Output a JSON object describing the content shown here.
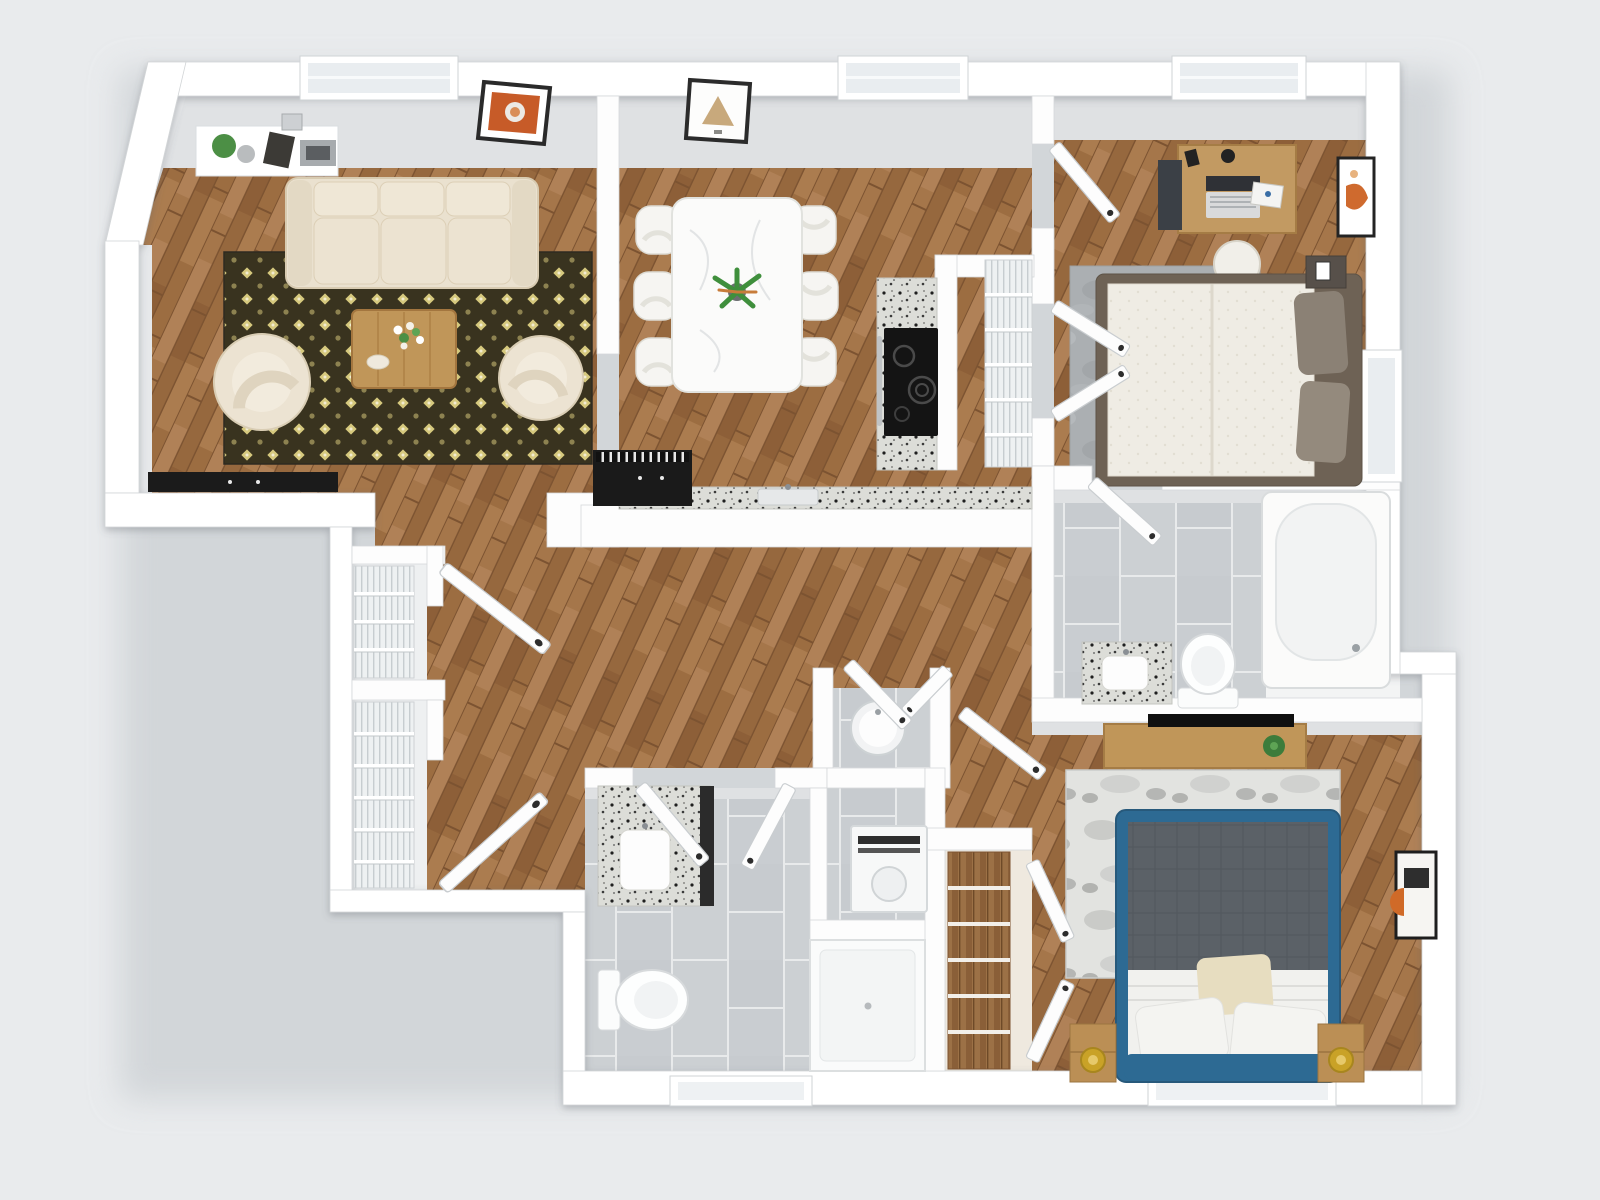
{
  "scene": {
    "description": "3D top-down rendering of a two-bedroom, two-bathroom apartment floor plan",
    "background_color": "#e9ebed",
    "palette": {
      "wall": "#ffffff",
      "wall_face": "#e0e2e4",
      "wood_floor": "#a5764a",
      "tile_floor": "#ccd0d3",
      "granite_counter": "#dcddd8",
      "cream_upholstery": "#eae1cf",
      "living_rug": "#39331f",
      "living_rug_accent": "#d6c97e",
      "bed2_frame_blue": "#2d6a93",
      "duvet_gray": "#5b6167",
      "accent_wood": "#c09659",
      "lamp_gold": "#c9a227",
      "art_orange": "#c75b28",
      "appliance_black": "#141414"
    },
    "rooms": [
      {
        "name": "living-room",
        "floor": "hardwood",
        "furniture": [
          "three-seat-sofa",
          "patterned-area-rug",
          "coffee-table-with-flowers",
          "swivel-armchair",
          "swivel-armchair",
          "media-console",
          "wall-shelf-with-plant-book-tray",
          "framed-orange-art",
          "window"
        ]
      },
      {
        "name": "dining-room",
        "floor": "hardwood",
        "furniture": [
          "marble-dining-table",
          "dining-chair-x6",
          "potted-centerpiece-plant",
          "framed-beige-art",
          "window"
        ]
      },
      {
        "name": "kitchen",
        "floor": "hardwood",
        "furniture": [
          "granite-counter-run",
          "granite-cooktop-counter",
          "black-cooktop",
          "sink",
          "black-sink-cabinet-with-dishrack",
          "wire-pantry-shelving"
        ]
      },
      {
        "name": "bedroom-1",
        "floor": "hardwood",
        "furniture": [
          "double-bed-brown-pillows",
          "gray-area-rug",
          "desk-with-laptop-books-speakers",
          "desk-chair",
          "file-cabinet",
          "nightstand-with-frame",
          "framed-abstract-art",
          "window",
          "closet-wire-shelving"
        ]
      },
      {
        "name": "bathroom-1",
        "floor": "gray-tile",
        "furniture": [
          "bathtub",
          "toilet",
          "granite-vanity-with-sink"
        ]
      },
      {
        "name": "bedroom-2",
        "floor": "hardwood",
        "furniture": [
          "blue-platform-bed-gray-duvet",
          "distressed-gray-rug",
          "wood-dresser-with-tv",
          "potted-plant",
          "nightstand-with-gold-lamp",
          "nightstand-with-gold-lamp",
          "framed-abstract-art",
          "window",
          "closet-wood-shelving"
        ]
      },
      {
        "name": "bathroom-2",
        "floor": "gray-tile",
        "furniture": [
          "granite-vanity-with-sink",
          "toilet",
          "walk-in-shower",
          "washer",
          "window"
        ]
      },
      {
        "name": "hallway",
        "floor": "hardwood",
        "furniture": [
          "wire-shelf-closet",
          "wire-shelf-closet",
          "water-heater-closet"
        ]
      }
    ],
    "counts": {
      "windows": 6,
      "open_door_panels": 13,
      "wall_art": 4,
      "skylights": 0
    },
    "labels_visible": "none"
  }
}
